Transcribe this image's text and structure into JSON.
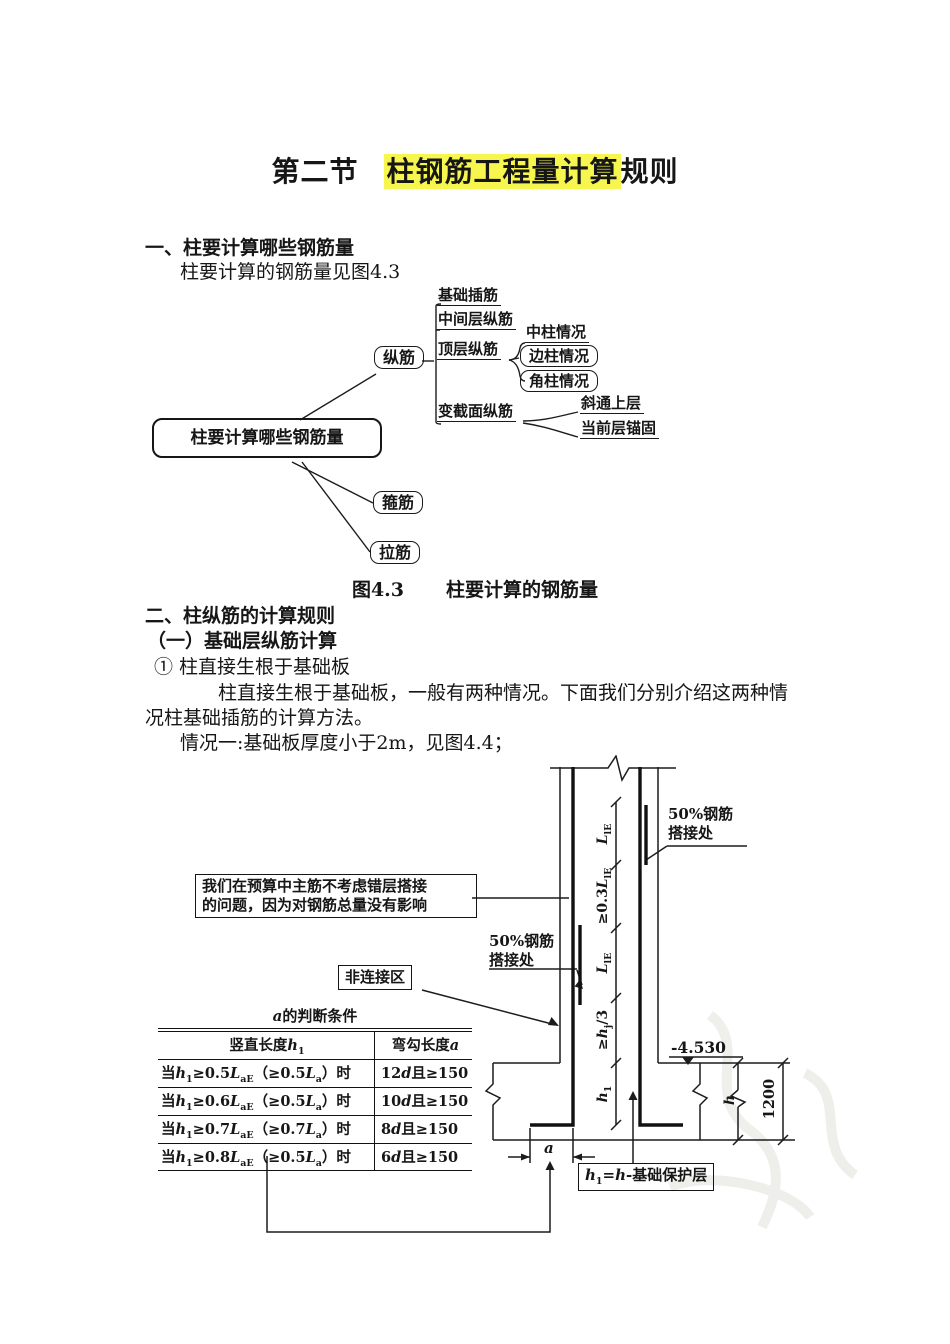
{
  "colors": {
    "highlight": "#f7f64e",
    "ink": "#161616"
  },
  "header": {
    "title_prefix": "第二节",
    "title_highlight": "柱钢筋工程量计算",
    "title_suffix": "规则"
  },
  "section1": {
    "heading": "一、柱要计算哪些钢筋量",
    "intro": "柱要计算的钢筋量见图4.3"
  },
  "fig43": {
    "root": "柱要计算哪些钢筋量",
    "zongjin": "纵筋",
    "children": [
      "基础插筋",
      "中间层纵筋",
      "顶层纵筋",
      "变截面纵筋"
    ],
    "top_cases": [
      "中柱情况",
      "边柱情况",
      "角柱情况"
    ],
    "var_cases": [
      "斜通上层",
      "当前层锚固"
    ],
    "gujin": "箍筋",
    "lajin": "拉筋",
    "caption_no": "图4.3",
    "caption_text": "柱要计算的钢筋量"
  },
  "section2": {
    "heading": "二、柱纵筋的计算规则",
    "sub_heading": "（一）基础层纵筋计算",
    "item1": "① 柱直接生根于基础板",
    "para_line1": "柱直接生根于基础板，一般有两种情况。下面我们分别介绍这两种情",
    "para_line2": "况柱基础插筋的计算方法。",
    "case1": "情况一:基础板厚度小于2m，见图4.4；"
  },
  "fig44": {
    "note_line1": "我们在预算中主筋不考虑错层搭接",
    "note_line2": "的问题，因为对钢筋总量没有影响",
    "lap_line1": "50%钢筋",
    "lap_line2": "搭接处",
    "non_connect": "非连接区",
    "level": "-4.530",
    "dim_1200": "1200",
    "dim_h": "h",
    "dim_a": "a",
    "dims": {
      "s1": {
        "p": "",
        "m": "L",
        "s": "lE",
        "x": ""
      },
      "s2": {
        "p": "≥0.3",
        "m": "L",
        "s": "lE",
        "x": ""
      },
      "s3": {
        "p": "",
        "m": "L",
        "s": "lE",
        "x": ""
      },
      "s4": {
        "p": "≥",
        "m": "h",
        "s": "j",
        "x": "/3"
      },
      "s5": {
        "p": "",
        "m": "h",
        "s": "1",
        "x": ""
      }
    },
    "formula": {
      "h1": "h",
      "sub1": "1",
      "eq": "=",
      "h2": "h",
      "rest": "-基础保护层"
    },
    "table": {
      "title_i": "a",
      "title_rest": "的判断条件",
      "col1_pre": "竖直长度",
      "col1_h": "h",
      "col1_sub": "1",
      "col2_pre": "弯勾长度",
      "col2_a": "a",
      "rows": [
        {
          "pre": "当",
          "h": "h",
          "hs": "1",
          "ge": "≥0.5",
          "L": "L",
          "Ls": "aE",
          "par": "（≥0.5",
          "L2": "L",
          "L2s": "a",
          "cl": "）时",
          "n": "12",
          "d": "d",
          "rest": "且≥150"
        },
        {
          "pre": "当",
          "h": "h",
          "hs": "1",
          "ge": "≥0.6",
          "L": "L",
          "Ls": "aE",
          "par": "（≥0.5",
          "L2": "L",
          "L2s": "a",
          "cl": "）时",
          "n": "10",
          "d": "d",
          "rest": "且≥150"
        },
        {
          "pre": "当",
          "h": "h",
          "hs": "1",
          "ge": "≥0.7",
          "L": "L",
          "Ls": "aE",
          "par": "（≥0.7",
          "L2": "L",
          "L2s": "a",
          "cl": "）时",
          "n": "8",
          "d": "d",
          "rest": "且≥150"
        },
        {
          "pre": "当",
          "h": "h",
          "hs": "1",
          "ge": "≥0.8",
          "L": "L",
          "Ls": "aE",
          "par": "（≥0.5",
          "L2": "L",
          "L2s": "a",
          "cl": "）时",
          "n": "6",
          "d": "d",
          "rest": "且≥150"
        }
      ]
    }
  }
}
